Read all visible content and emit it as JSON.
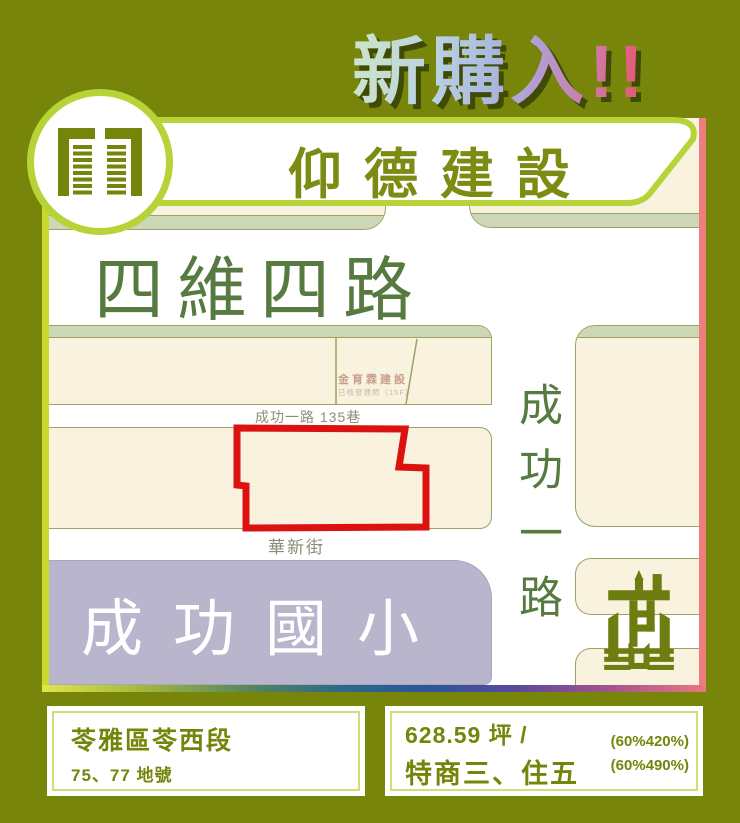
{
  "heading": {
    "text": "新購入!!"
  },
  "banner": {
    "title": "仰德建設"
  },
  "map": {
    "roads": {
      "top_road": "四維四路",
      "lane": "成功一路 135巷",
      "street": "華新街",
      "vertical_road": "成功一路"
    },
    "labels": {
      "neighbor_name": "金育霖建設",
      "neighbor_note": "已核發建照（15F）",
      "school": "成功國小"
    }
  },
  "footer": {
    "left": {
      "line1": "苓雅區苓西段",
      "line2": "75、77 地號"
    },
    "right": {
      "line1": "628.59 坪 /",
      "line2": "特商三、住五",
      "note1": "(60%420%)",
      "note2": "(60%490%)"
    }
  },
  "icons": {
    "logo": "building-towers-icon",
    "machine": "construction-rig-icon"
  },
  "colors": {
    "background_olive": "#77850b",
    "accent_red": "#dc1210",
    "banner_green": "#b6d437",
    "map_border_yellow_green": "#cada2d",
    "map_border_pink": "#ee7d80",
    "block_cream": "#f8f2de",
    "block_sage": "#ccd7b5",
    "school_purple": "#b8b5cd"
  }
}
